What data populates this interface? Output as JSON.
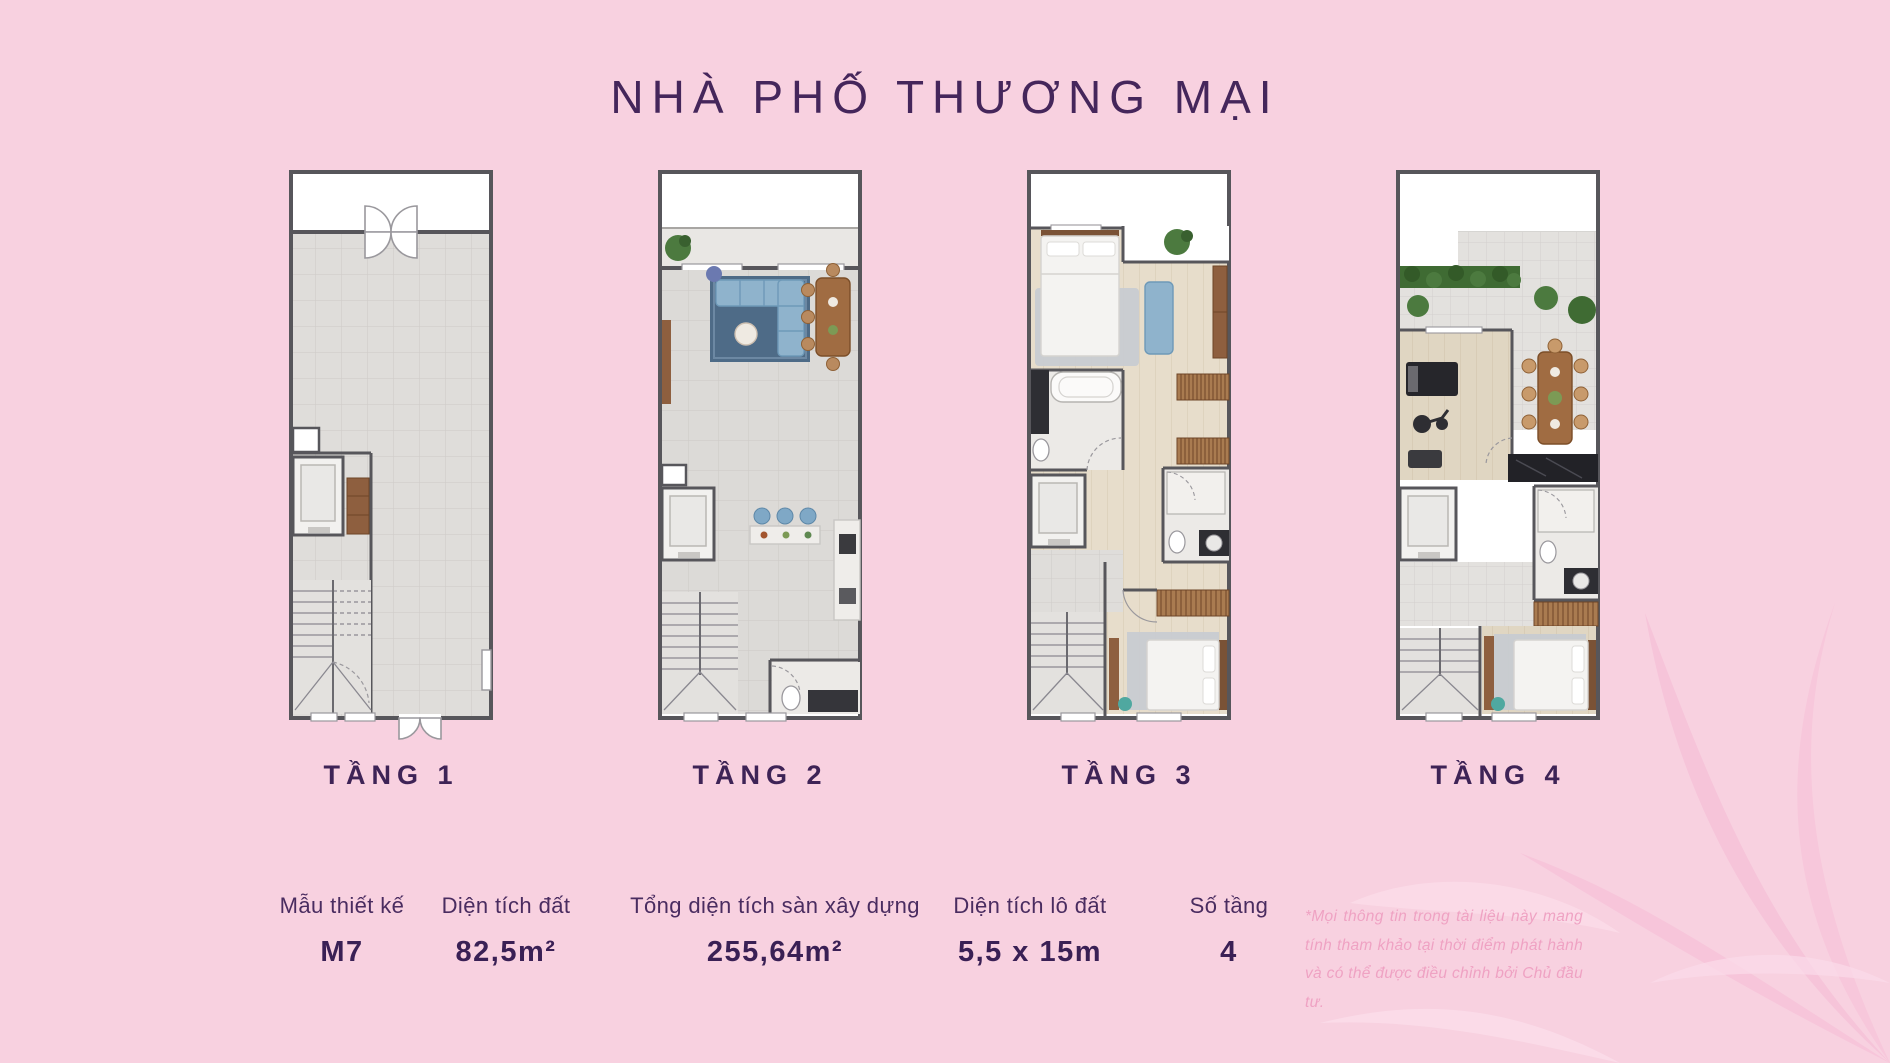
{
  "page": {
    "title": "NHÀ PHỐ THƯƠNG MẠI"
  },
  "floors": [
    {
      "label": "TẦNG 1"
    },
    {
      "label": "TẦNG 2"
    },
    {
      "label": "TẦNG 3"
    },
    {
      "label": "TẦNG 4"
    }
  ],
  "specs": [
    {
      "label": "Mẫu thiết kế",
      "value": "M7"
    },
    {
      "label": "Diện tích đất",
      "value": "82,5m²"
    },
    {
      "label": "Tổng diện tích sàn xây dựng",
      "value": "255,64m²"
    },
    {
      "label": "Diện tích lô đất",
      "value": "5,5 x 15m"
    },
    {
      "label": "Số tầng",
      "value": "4"
    }
  ],
  "disclaimer": "*Mọi thông tin trong tài liệu này mang tính tham khảo tại thời điểm phát hành và có thể được điều chỉnh bởi Chủ đầu tư.",
  "colors": {
    "background": "#F8D1E0",
    "accent_purple": "#45265B",
    "disclaimer_pink": "#EFA2C3",
    "plan_wall": "#57565B"
  }
}
